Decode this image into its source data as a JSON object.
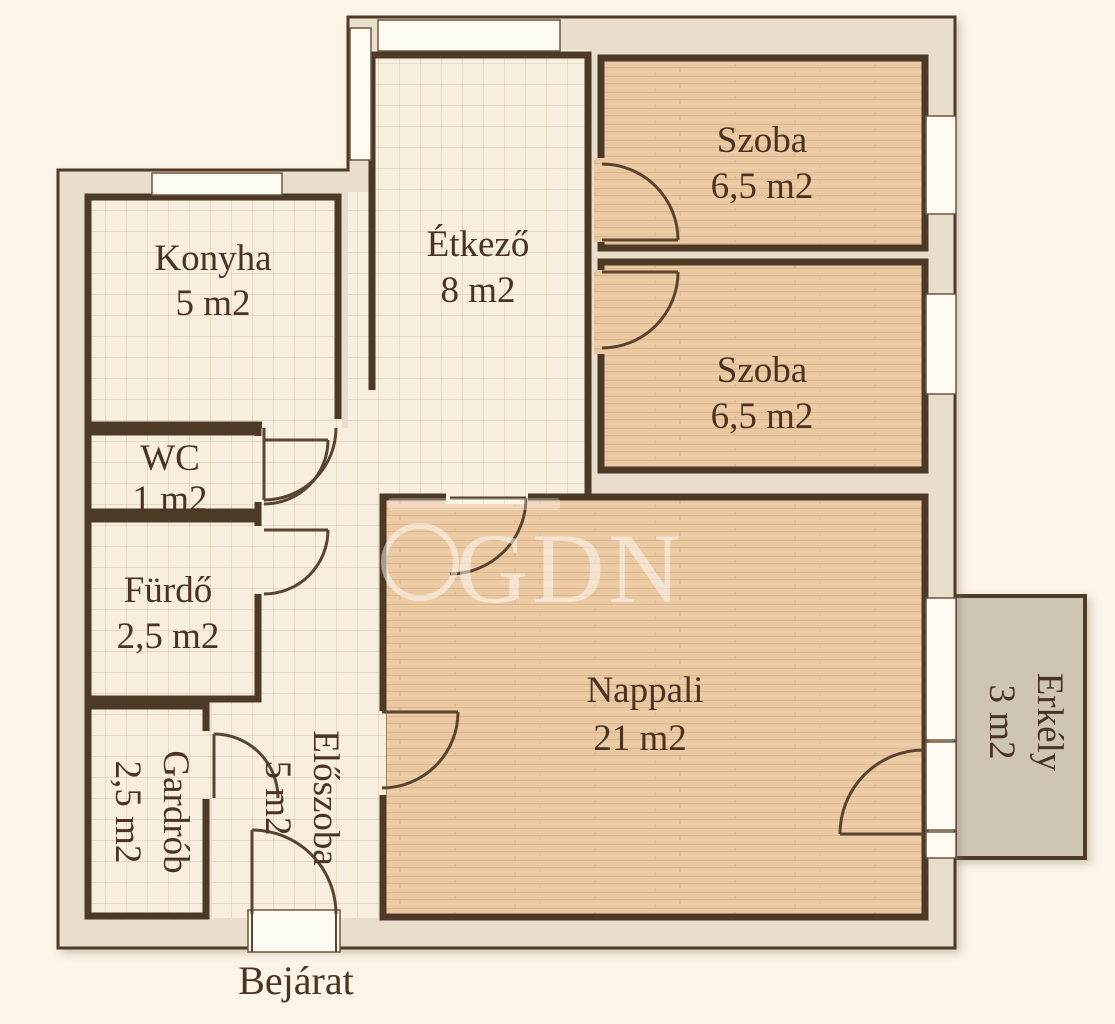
{
  "plan": {
    "rooms": [
      {
        "id": "konyha",
        "name": "Konyha",
        "area": "5 m2"
      },
      {
        "id": "wc",
        "name": "WC",
        "area": "1 m2"
      },
      {
        "id": "furdo",
        "name": "Fürdő",
        "area": "2,5 m2"
      },
      {
        "id": "gardrob",
        "name": "Gardrób",
        "area": "2,5 m2"
      },
      {
        "id": "eloszoba",
        "name": "Előszoba",
        "area": "5 m2"
      },
      {
        "id": "etkezo",
        "name": "Étkező",
        "area": "8 m2"
      },
      {
        "id": "szoba1",
        "name": "Szoba",
        "area": "6,5 m2"
      },
      {
        "id": "szoba2",
        "name": "Szoba",
        "area": "6,5 m2"
      },
      {
        "id": "nappali",
        "name": "Nappali",
        "area": "21 m2"
      },
      {
        "id": "erkely",
        "name": "Erkély",
        "area": "3 m2"
      }
    ],
    "entrance_label": "Bejárat",
    "watermark": "GDN",
    "colors": {
      "background": "#fbf4e7",
      "wall_fill": "#e9decb",
      "wall_line": "#4d3a26",
      "tile_floor": "#f7eede",
      "wood_floor": "#eac8a1",
      "balcony_fill": "#cec5b3",
      "window_fill": "#fdfaf2",
      "label_text": "#4a3322",
      "watermark_color": "#ffffff"
    }
  }
}
